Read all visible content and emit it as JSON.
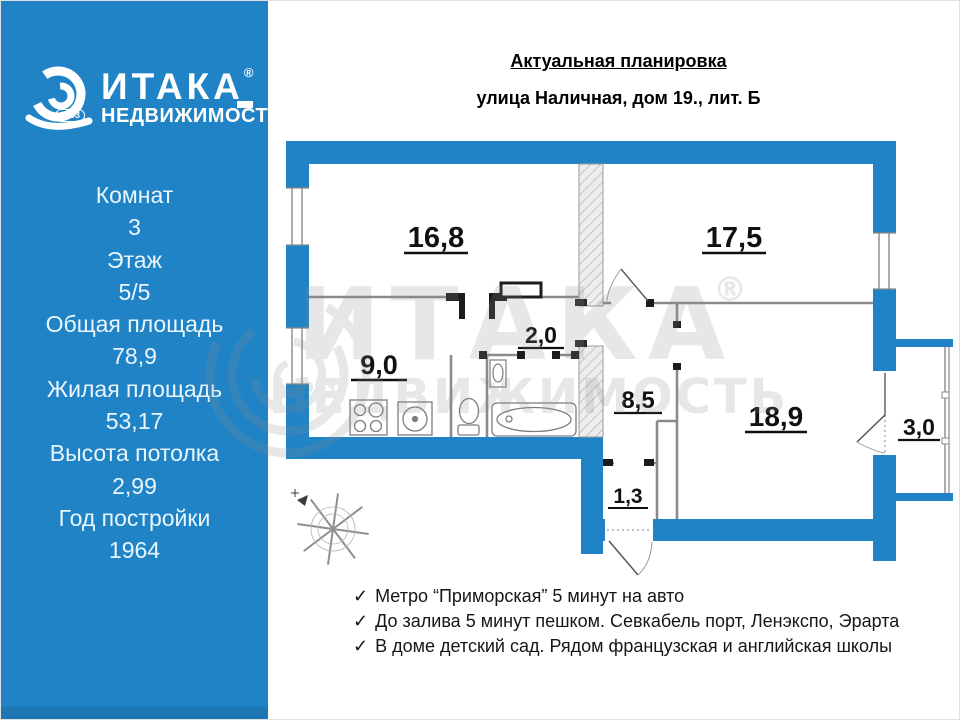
{
  "colors": {
    "brand_blue": "#2083C6",
    "wall_blue": "#2083C6"
  },
  "sidebar": {
    "logo": {
      "brand": "ИТАКА",
      "registered": "®",
      "tagline": "НЕДВИЖИМОСТЬ",
      "year_badge": "1993"
    },
    "specs": [
      {
        "label": "Комнат",
        "value": "3"
      },
      {
        "label": "Этаж",
        "value": "5/5"
      },
      {
        "label": "Общая площадь",
        "value": "78,9"
      },
      {
        "label": "Жилая площадь",
        "value": "53,17"
      },
      {
        "label": "Высота потолка",
        "value": "2,99"
      },
      {
        "label": "Год постройки",
        "value": "1964"
      }
    ]
  },
  "header": {
    "title": "Актуальная планировка",
    "address": "улица Наличная, дом 19., лит. Б"
  },
  "plan": {
    "rooms": {
      "living1": "16,8",
      "living2": "17,5",
      "kitchen": "9,0",
      "corridor": "2,0",
      "hall": "8,5",
      "living3": "18,9",
      "balcony": "3,0",
      "vestibule": "1,3"
    },
    "watermark": {
      "brand": "ИТАКА",
      "registered": "®",
      "tagline": "НЕДВИЖИМОСТЬ",
      "year": "1993"
    }
  },
  "features": {
    "items": [
      {
        "icon": "✓",
        "text": "Метро “Приморская” 5 минут на авто"
      },
      {
        "icon": "✓",
        "text": "До залива 5 минут пешком. Севкабель порт, Ленэкспо, Эрарта"
      },
      {
        "icon": "✓",
        "text": "В доме детский сад. Рядом французская и английская школы"
      }
    ]
  }
}
